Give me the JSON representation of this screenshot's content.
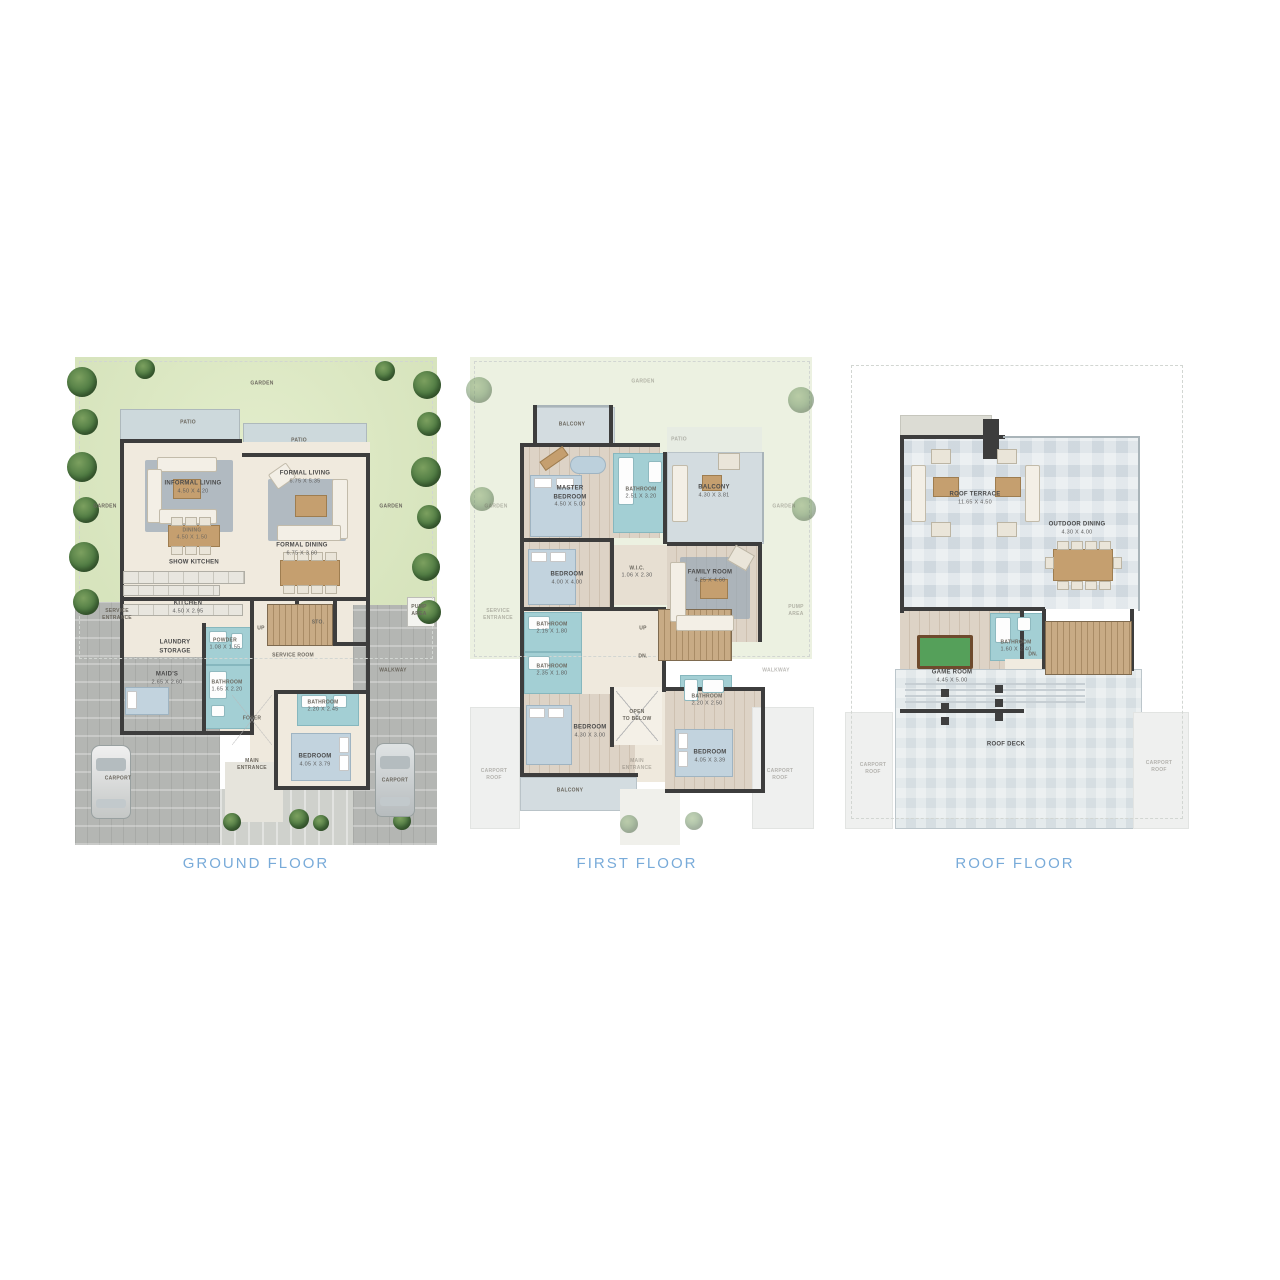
{
  "colors": {
    "accent_label_blue": "#79abd9",
    "garden_green": "#dbe7c4",
    "patio_gray": "#cdd9dc",
    "interior_beige": "#f0eade",
    "wood_tan": "#ddd3c6",
    "bathroom_teal": "#a3cfd4",
    "wall_dark": "#3d3d3d",
    "carport_gray": "#b4b6b3",
    "deck_blue_gray": "#e0e6ea",
    "stair_wood": "#c2a482",
    "pool_green": "#55a05a"
  },
  "floors": [
    {
      "name": "GROUND FLOOR",
      "rooms": [
        {
          "label": "GARDEN",
          "dims": ""
        },
        {
          "label": "PATIO",
          "dims": ""
        },
        {
          "label": "PATIO",
          "dims": ""
        },
        {
          "label": "INFORMAL LIVING",
          "dims": "4.50 X 4.20"
        },
        {
          "label": "FORMAL LIVING",
          "dims": "6.75 X 5.35"
        },
        {
          "label": "GARDEN",
          "dims": ""
        },
        {
          "label": "GARDEN",
          "dims": ""
        },
        {
          "label": "DINING",
          "dims": "4.50 X 1.50"
        },
        {
          "label": "FORMAL DINING",
          "dims": "6.75 X 3.60"
        },
        {
          "label": "SHOW KITCHEN",
          "dims": ""
        },
        {
          "label": "KITCHEN",
          "dims": "4.50 X 2.95"
        },
        {
          "label": "SERVICE\nENTRANCE",
          "dims": ""
        },
        {
          "label": "LAUNDRY\nSTORAGE",
          "dims": ""
        },
        {
          "label": "POWDER",
          "dims": "1.08 X 1.55"
        },
        {
          "label": "UP",
          "dims": ""
        },
        {
          "label": "STO.",
          "dims": ""
        },
        {
          "label": "SERVICE ROOM",
          "dims": ""
        },
        {
          "label": "MAID'S",
          "dims": "2.65 X 2.60"
        },
        {
          "label": "BATHROOM",
          "dims": "1.65 X 2.20"
        },
        {
          "label": "WALKWAY",
          "dims": ""
        },
        {
          "label": "PUMP\nAREA",
          "dims": ""
        },
        {
          "label": "BATHROOM",
          "dims": "2.20 X 2.45"
        },
        {
          "label": "FOYER",
          "dims": ""
        },
        {
          "label": "CARPORT",
          "dims": ""
        },
        {
          "label": "MAIN\nENTRANCE",
          "dims": ""
        },
        {
          "label": "BEDROOM",
          "dims": "4.05 X 3.79"
        },
        {
          "label": "CARPORT",
          "dims": ""
        }
      ]
    },
    {
      "name": "FIRST FLOOR",
      "rooms": [
        {
          "label": "GARDEN",
          "dims": ""
        },
        {
          "label": "BALCONY",
          "dims": ""
        },
        {
          "label": "PATIO",
          "dims": ""
        },
        {
          "label": "MASTER\nBEDROOM",
          "dims": "4.50 X 5.00"
        },
        {
          "label": "BATHROOM",
          "dims": "2.51 X 3.20"
        },
        {
          "label": "BALCONY",
          "dims": "4.30 X 3.81"
        },
        {
          "label": "GARDEN",
          "dims": ""
        },
        {
          "label": "GARDEN",
          "dims": ""
        },
        {
          "label": "W.I.C.",
          "dims": "1.06 X 2.30"
        },
        {
          "label": "FAMILY ROOM",
          "dims": "4.25 X 4.60"
        },
        {
          "label": "BEDROOM",
          "dims": "4.00 X 4.00"
        },
        {
          "label": "SERVICE\nENTRANCE",
          "dims": ""
        },
        {
          "label": "BATHROOM",
          "dims": "2.15 X 1.80"
        },
        {
          "label": "UP",
          "dims": ""
        },
        {
          "label": "DN.",
          "dims": ""
        },
        {
          "label": "BATHROOM",
          "dims": "2.35 X 1.80"
        },
        {
          "label": "WALKWAY",
          "dims": ""
        },
        {
          "label": "BATHROOM",
          "dims": "2.20 X 2.50"
        },
        {
          "label": "OPEN\nTO BELOW",
          "dims": ""
        },
        {
          "label": "BEDROOM",
          "dims": "4.30 X 3.00"
        },
        {
          "label": "MAIN\nENTRANCE",
          "dims": ""
        },
        {
          "label": "BEDROOM",
          "dims": "4.05 X 3.39"
        },
        {
          "label": "CARPORT\nROOF",
          "dims": ""
        },
        {
          "label": "BALCONY",
          "dims": ""
        },
        {
          "label": "CARPORT\nROOF",
          "dims": ""
        },
        {
          "label": "PUMP\nAREA",
          "dims": ""
        }
      ]
    },
    {
      "name": "ROOF FLOOR",
      "rooms": [
        {
          "label": "ROOF TERRACE",
          "dims": "11.65 X 4.50"
        },
        {
          "label": "OUTDOOR DINING",
          "dims": "4.30 X 4.00"
        },
        {
          "label": "BATHROOM",
          "dims": "1.60 X 2.40"
        },
        {
          "label": "GAME ROOM",
          "dims": "4.45 X 5.00"
        },
        {
          "label": "DN.",
          "dims": ""
        },
        {
          "label": "ROOF DECK",
          "dims": ""
        },
        {
          "label": "CARPORT\nROOF",
          "dims": ""
        },
        {
          "label": "CARPORT\nROOF",
          "dims": ""
        }
      ]
    }
  ]
}
